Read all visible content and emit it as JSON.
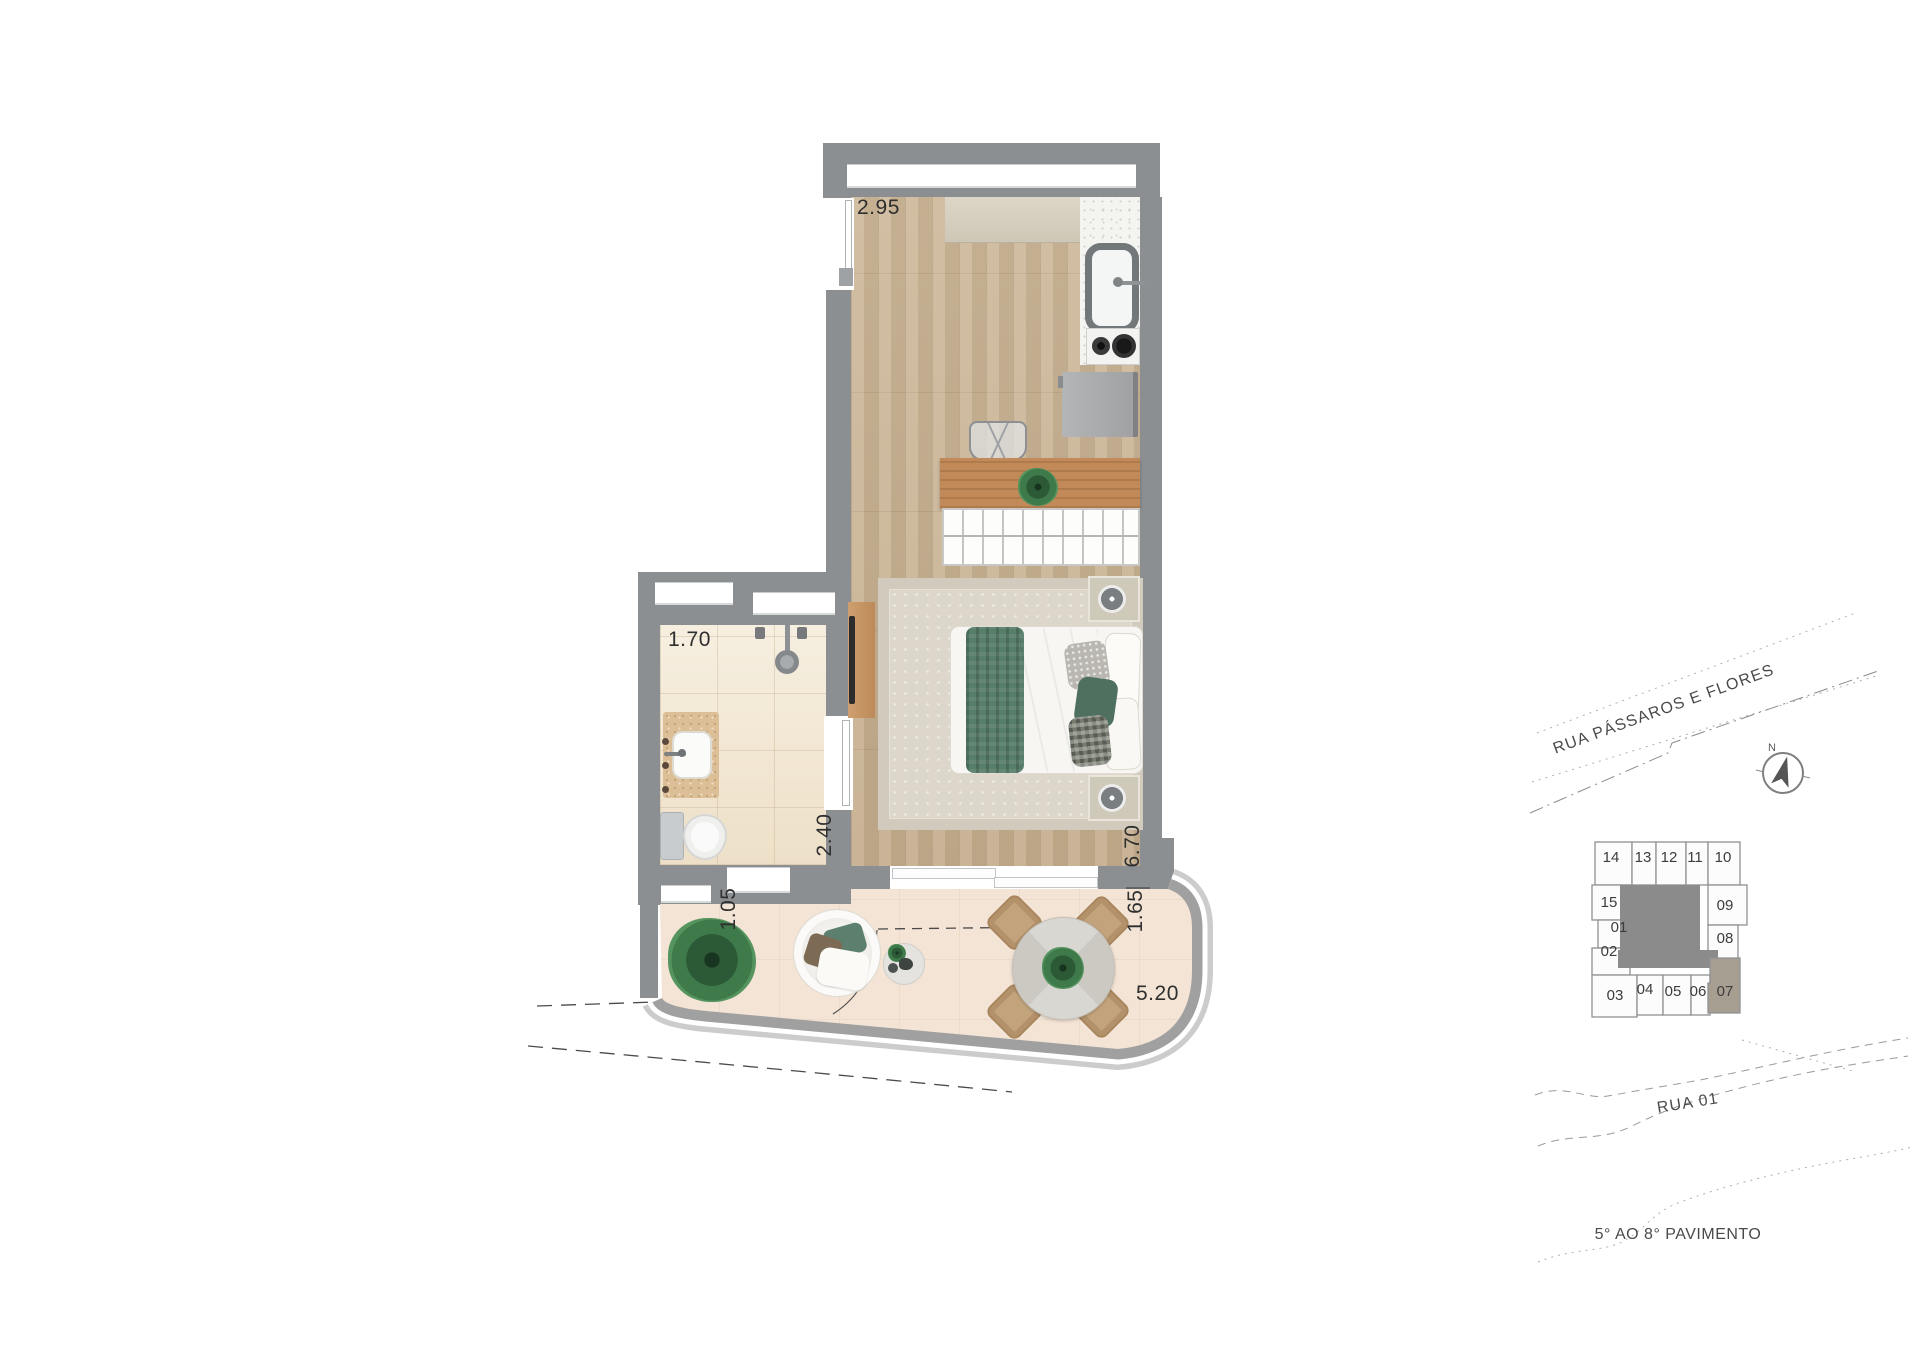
{
  "plan": {
    "dimensions": {
      "kitchen_width": "2.95",
      "bathroom_width": "1.70",
      "bathroom_depth": "2.40",
      "room_depth": "6.70",
      "balcony_depth_left": "1.05",
      "balcony_depth_right": "1.65",
      "balcony_width": "5.20"
    },
    "colors": {
      "wall": "#8b8f91",
      "wood_floor": "#c9b394",
      "bath_floor": "#f4ecdb",
      "balcony_floor": "#f3e4d5",
      "accent_green": "#577e6a",
      "keyplan_highlight": "#a69e90"
    }
  },
  "site_plan": {
    "street_upper": "RUA PÁSSAROS E FLORES",
    "street_lower": "RUA 01",
    "floor_range_label": "5° AO 8° PAVIMENTO",
    "compass_north": "N",
    "key_plan": {
      "highlighted_unit": "07",
      "units": [
        "14",
        "13",
        "12",
        "11",
        "10",
        "15",
        "01",
        "02",
        "09",
        "08",
        "03",
        "04",
        "05",
        "06",
        "07"
      ]
    }
  }
}
